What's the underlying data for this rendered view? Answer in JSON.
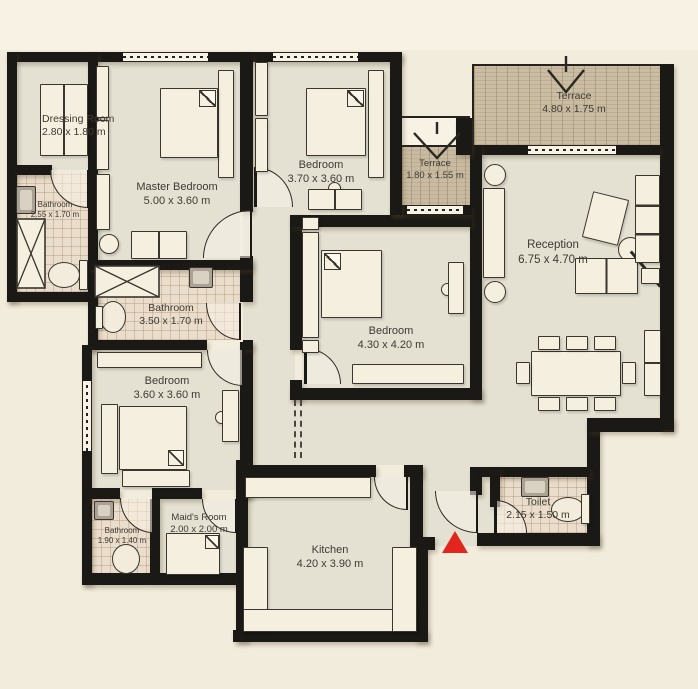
{
  "plan": {
    "colors": {
      "background": "#f2ecdc",
      "wall": "#1b1915",
      "floor": "#e4e1d2",
      "bathroom_tile": "#eaddcb",
      "terrace_wood": "#cbbda3",
      "entrance_accent": "#e3261d"
    },
    "rooms": {
      "dressing_room": {
        "name": "Dressing Room",
        "size": "2.80 x 1.80 m"
      },
      "bathroom_ensuite": {
        "name": "Bathroom",
        "size": "2.55 x 1.70 m"
      },
      "master_bedroom": {
        "name": "Master Bedroom",
        "size": "5.00 x 3.60 m"
      },
      "bedroom_top": {
        "name": "Bedroom",
        "size": "3.70 x 3.60 m"
      },
      "terrace_small": {
        "name": "Terrace",
        "size": "1.80 x 1.55 m"
      },
      "terrace_large": {
        "name": "Terrace",
        "size": "4.80 x 1.75 m"
      },
      "reception": {
        "name": "Reception",
        "size": "6.75 x 4.70 m"
      },
      "bathroom_main": {
        "name": "Bathroom",
        "size": "3.50 x 1.70 m"
      },
      "bedroom_middle": {
        "name": "Bedroom",
        "size": "4.30 x 4.20 m"
      },
      "bedroom_lower": {
        "name": "Bedroom",
        "size": "3.60 x 3.60 m"
      },
      "bathroom_small": {
        "name": "Bathroom",
        "size": "1.90 x 1.40 m"
      },
      "maids_room": {
        "name": "Maid's Room",
        "size": "2.00 x 2.00 m"
      },
      "kitchen": {
        "name": "Kitchen",
        "size": "4.20 x 3.90 m"
      },
      "toilet": {
        "name": "Toilet",
        "size": "2.15 x 1.50 m"
      }
    }
  }
}
